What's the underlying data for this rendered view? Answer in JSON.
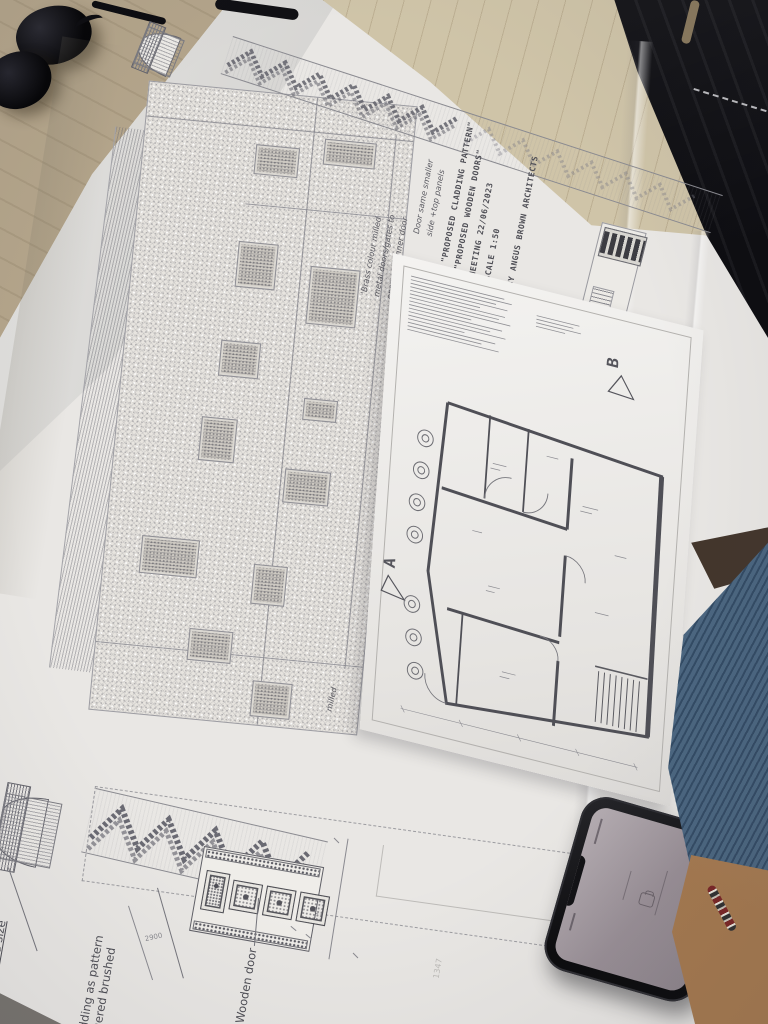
{
  "photo": {
    "description": "Photograph of architectural drawings (mosque facade elevation with cladding pattern and wooden doors, plus a floor plan sheet) spread on a table, with sunglasses top-left, a smartphone bottom-right and a person's arm at the right edge",
    "colors": {
      "paper": "#e9e7e4",
      "ink": "#55555c",
      "table": "#b3a48a",
      "floor": "#cfc4a8",
      "jacket": "#0c0c10",
      "phone_case": "#141416",
      "phone_screen": "#a39aa1",
      "denim": "#4b6680",
      "skin": "#b98e66"
    }
  },
  "titles": {
    "line1": "\"PROPOSED CLADDING PATTERN\"",
    "line2": "\"PROPOSED WOODEN DOORS\"",
    "line3": "MEETING 22/06/2023",
    "scale": "SCALE 1:50",
    "author": "BY ANGUS BROWN ARCHITECTS"
  },
  "handwritten_notes": {
    "door_note": "Door same smaller\nside +top panels",
    "brass_note": "'Brass colour milled\nmetal doors/gates to\nopen with inner door",
    "partial_milled": "milled"
  },
  "elevation_labels": {
    "wooden_door": "Wooden door",
    "cladding": "al cladding as pattern\nin laquered brushed\nsteel.",
    "and_size": "and size",
    "left_edge_partial": "door",
    "dim_2900": "2900",
    "dim_faint": "1347"
  },
  "floor_plan": {
    "marker_a": "A",
    "marker_b": "B"
  }
}
